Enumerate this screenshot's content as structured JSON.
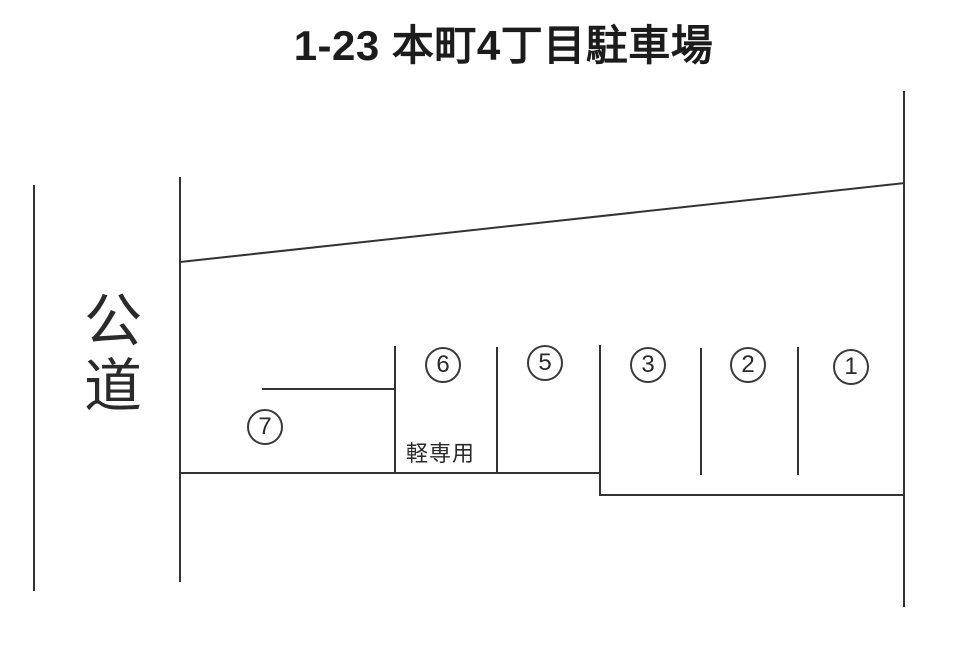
{
  "title": "1-23 本町4丁目駐車場",
  "road": {
    "label": "公道"
  },
  "stalls": [
    {
      "number": "1"
    },
    {
      "number": "2"
    },
    {
      "number": "3"
    },
    {
      "number": "5"
    },
    {
      "number": "6",
      "note": "軽専用"
    },
    {
      "number": "7"
    }
  ],
  "colors": {
    "line": "#333333",
    "text": "#1c1c1c",
    "background": "#ffffff"
  }
}
